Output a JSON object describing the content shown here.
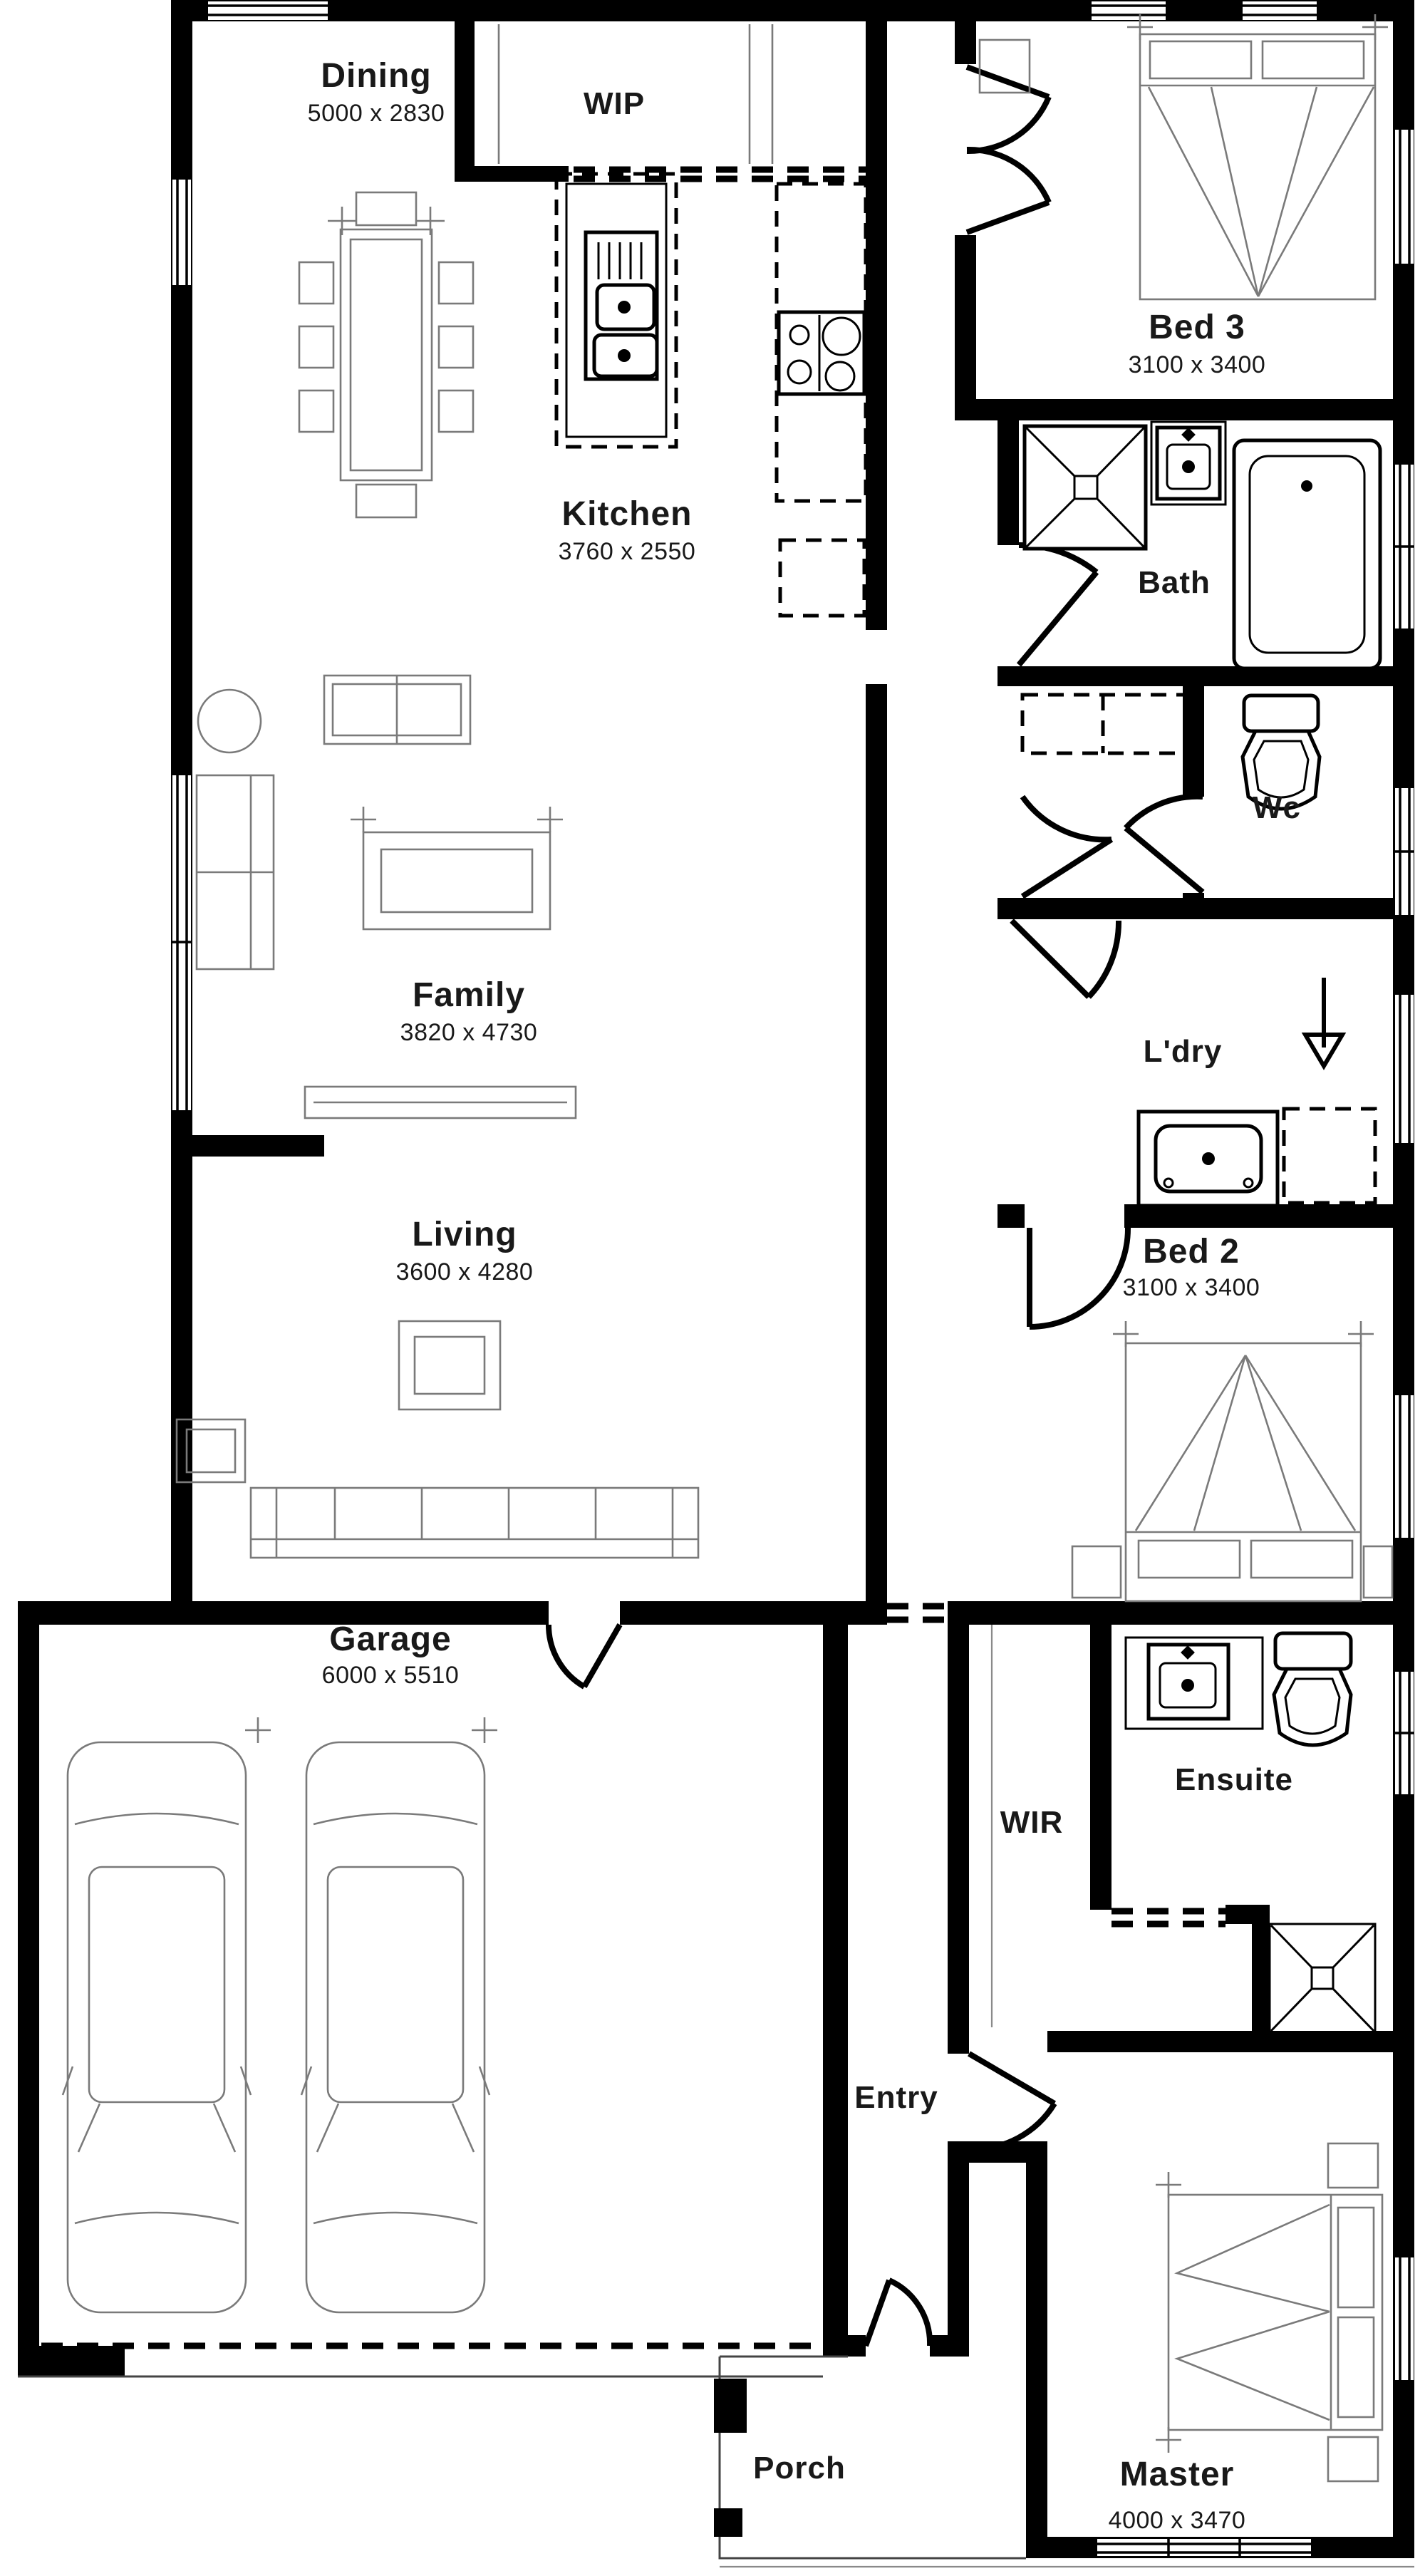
{
  "plan": {
    "type": "floor-plan",
    "background_color": "#ffffff",
    "wall_color": "#000000",
    "furniture_line_color": "#7a7a7a",
    "text_color": "#191919",
    "rooms": [
      {
        "id": "dining",
        "label": "Dining",
        "dims": "5000 x 2830"
      },
      {
        "id": "wip",
        "label": "WIP",
        "dims": ""
      },
      {
        "id": "bed3",
        "label": "Bed 3",
        "dims": "3100 x 3400"
      },
      {
        "id": "kitchen",
        "label": "Kitchen",
        "dims": "3760 x 2550"
      },
      {
        "id": "bath",
        "label": "Bath",
        "dims": ""
      },
      {
        "id": "wc",
        "label": "Wc",
        "dims": ""
      },
      {
        "id": "family",
        "label": "Family",
        "dims": "3820 x 4730"
      },
      {
        "id": "ldry",
        "label": "L'dry",
        "dims": ""
      },
      {
        "id": "living",
        "label": "Living",
        "dims": "3600 x 4280"
      },
      {
        "id": "bed2",
        "label": "Bed 2",
        "dims": "3100 x 3400"
      },
      {
        "id": "garage",
        "label": "Garage",
        "dims": "6000 x 5510"
      },
      {
        "id": "wir",
        "label": "WIR",
        "dims": ""
      },
      {
        "id": "ensuite",
        "label": "Ensuite",
        "dims": ""
      },
      {
        "id": "entry",
        "label": "Entry",
        "dims": ""
      },
      {
        "id": "porch",
        "label": "Porch",
        "dims": ""
      },
      {
        "id": "master",
        "label": "Master",
        "dims": "4000 x 3470"
      }
    ]
  }
}
